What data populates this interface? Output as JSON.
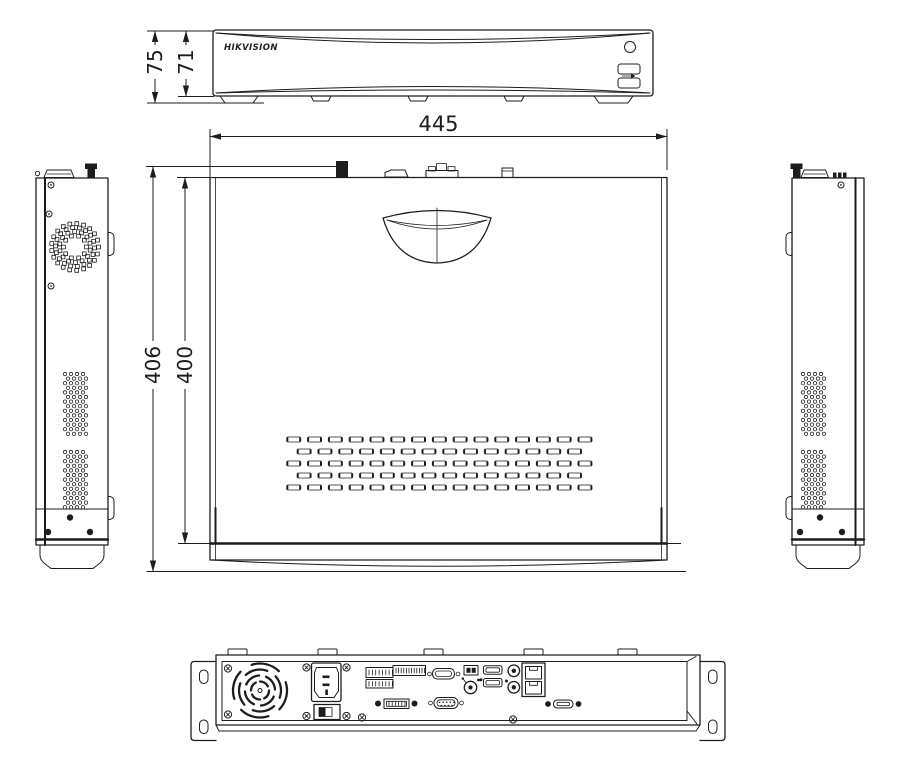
{
  "drawing": {
    "brand_label": "HIKVISION",
    "colors": {
      "background": "#ffffff",
      "line": "#1d1d1d"
    },
    "dimensions": {
      "width": "445",
      "depth_total": "406",
      "depth_body": "400",
      "height_total": "75",
      "height_body": "71"
    },
    "views": [
      {
        "id": "front-view",
        "label": "front"
      },
      {
        "id": "top-view",
        "label": "top"
      },
      {
        "id": "left-side-view",
        "label": "left side"
      },
      {
        "id": "right-side-view",
        "label": "right side"
      },
      {
        "id": "rear-view",
        "label": "rear"
      }
    ]
  }
}
